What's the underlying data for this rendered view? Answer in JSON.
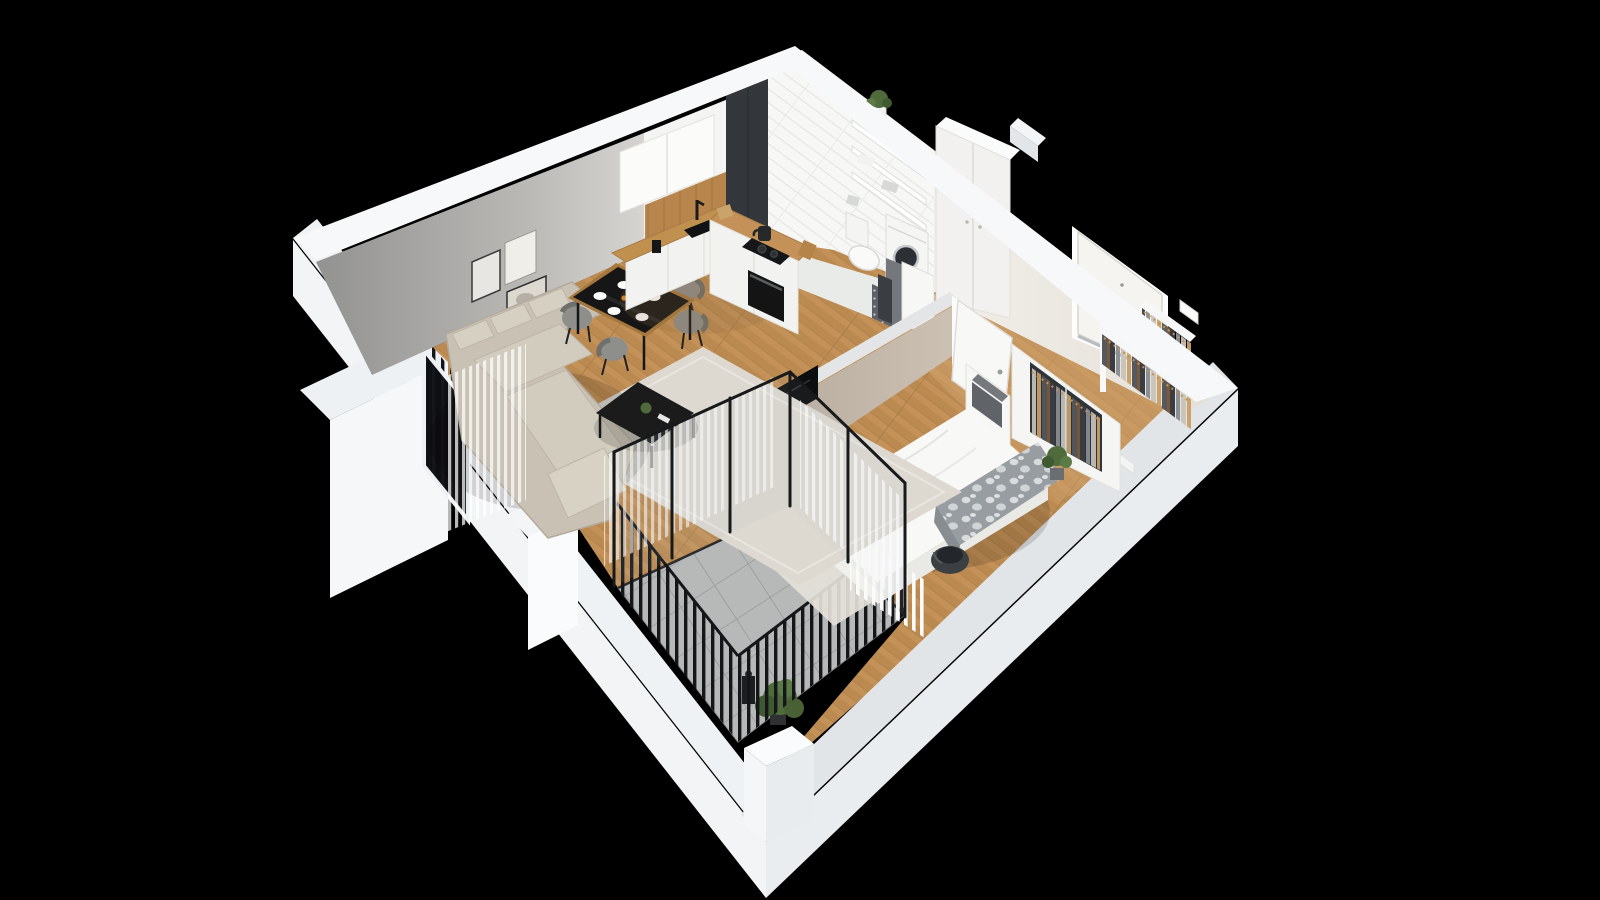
{
  "scene": {
    "title": "3D apartment floor plan render",
    "type": "isometric-3d-floorplan",
    "background": "black",
    "rooms": [
      {
        "name": "living-room",
        "floor": "wood planks with light rug",
        "furniture": [
          "corner-sofa-beige",
          "black-coffee-table",
          "area-rug",
          "wall-art-three-frames",
          "tv-on-partition-wall",
          "window-with-black-railing",
          "sheer-curtains"
        ]
      },
      {
        "name": "dining-area",
        "furniture": [
          "black-dining-table-wood-rim",
          "four-gray-chairs",
          "white-plates",
          "vase-with-flowers",
          "oranges"
        ]
      },
      {
        "name": "kitchen",
        "floor": "wood planks",
        "furniture": [
          "white-upper-cabinets",
          "wood-backsplash-panel",
          "counter-with-black-sink",
          "black-faucet",
          "moka-pot",
          "kettle",
          "black-cooktop-with-pots",
          "built-in-oven",
          "peninsula-cabinets",
          "cutting-boards"
        ]
      },
      {
        "name": "bathroom",
        "floor": "white tile",
        "furniture": [
          "black-tiled-walk-in-shower",
          "chrome-shower-column",
          "white-tile-walls",
          "wall-shelves",
          "potted-plant",
          "towels",
          "toilet",
          "washing-machine",
          "laundry-basket"
        ]
      },
      {
        "name": "hallway",
        "floor": "wood planks",
        "furniture": [
          "entrance-door-white",
          "tall-white-wardrobe",
          "open-clothes-rack-with-hangers",
          "second-clothes-rack",
          "shoe-shelf",
          "small-wall-shelf"
        ]
      },
      {
        "name": "bedroom",
        "floor": "wood planks with small rug",
        "furniture": [
          "double-bed-white",
          "patterned-gray-blanket",
          "round-dark-planter",
          "open-wardrobe-with-clothes",
          "shelf-unit-with-two-boxes",
          "open-white-door",
          "potted-plant",
          "white-radiator",
          "sheer-curtains",
          "glass-balcony-doors"
        ]
      },
      {
        "name": "balcony",
        "floor": "gray concrete tiles grid",
        "furniture": [
          "black-metal-railing",
          "potted-plant",
          "black-lantern"
        ]
      }
    ],
    "walls": {
      "exterior": "white cut walls",
      "living_back_wall": "gray plaster",
      "partition_living_bedroom": "taupe",
      "entry_wall": "cream with white entrance door"
    }
  },
  "palette": {
    "background": "#000000",
    "exterior_wall": "#f2f4f5",
    "wall_cap_light": "#f6f8f9",
    "wall_cap_dark": "#e2e5e7",
    "living_wall_gray": "#9a9a98",
    "kitchen_wall": "#f4f4f2",
    "bathroom_tile": "#f7f7f5",
    "dark_shower_tile": "#33373b",
    "hall_wall_cream": "#f0ede7",
    "partition_taupe": "#bfb3a5",
    "wood_floor": "#c49258",
    "bathroom_floor": "#e9ebe9",
    "balcony_tile": "#b6b9b8",
    "rug": "#ddd9d1",
    "sofa": "#c9c2b4",
    "bed_linen": "#f8f8f6",
    "blanket_gray": "#9aa0a4",
    "door_white": "#f5f4f1",
    "railing_black": "#141619",
    "counter_wood": "#c0904f",
    "cabinet_white": "#f2f2f0",
    "plant_green": "#4f6b3c",
    "furniture_black": "#0c0d0e"
  }
}
